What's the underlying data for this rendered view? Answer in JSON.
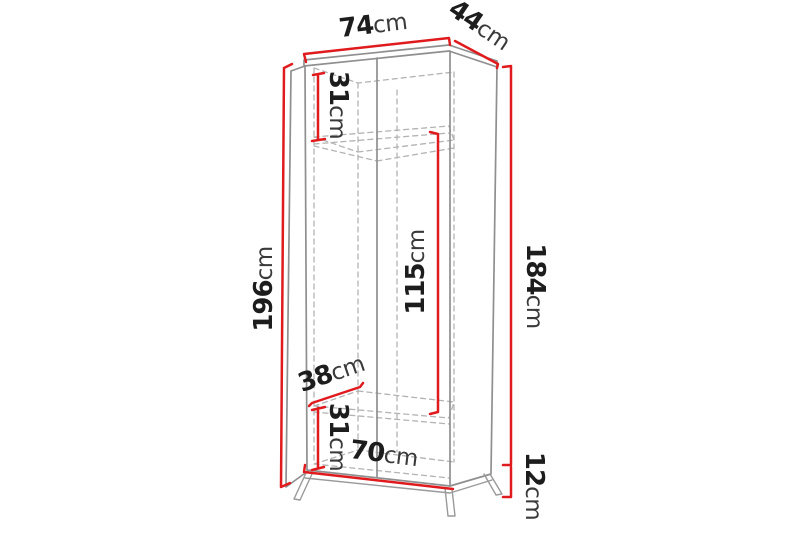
{
  "diagram": {
    "kind": "wardrobe-dimension-diagram",
    "unit": "cm",
    "colors": {
      "dimension_line": "#e01b1e",
      "outline": "#8f8f8f",
      "hidden_line": "#b3b3b3",
      "label_number": "#1d1d1d",
      "label_unit": "#3a3a3a",
      "background": "#ffffff"
    }
  },
  "dims": {
    "top_width": {
      "value": "74",
      "unit": "cm"
    },
    "top_depth": {
      "value": "44",
      "unit": "cm"
    },
    "upper_compartment": {
      "value": "31",
      "unit": "cm"
    },
    "total_height": {
      "value": "196",
      "unit": "cm"
    },
    "body_height": {
      "value": "184",
      "unit": "cm"
    },
    "hanging_space_height": {
      "value": "115",
      "unit": "cm"
    },
    "shelf_depth": {
      "value": "38",
      "unit": "cm"
    },
    "lower_compartment": {
      "value": "31",
      "unit": "cm"
    },
    "bottom_width": {
      "value": "70",
      "unit": "cm"
    },
    "leg_height": {
      "value": "12",
      "unit": "cm"
    }
  }
}
